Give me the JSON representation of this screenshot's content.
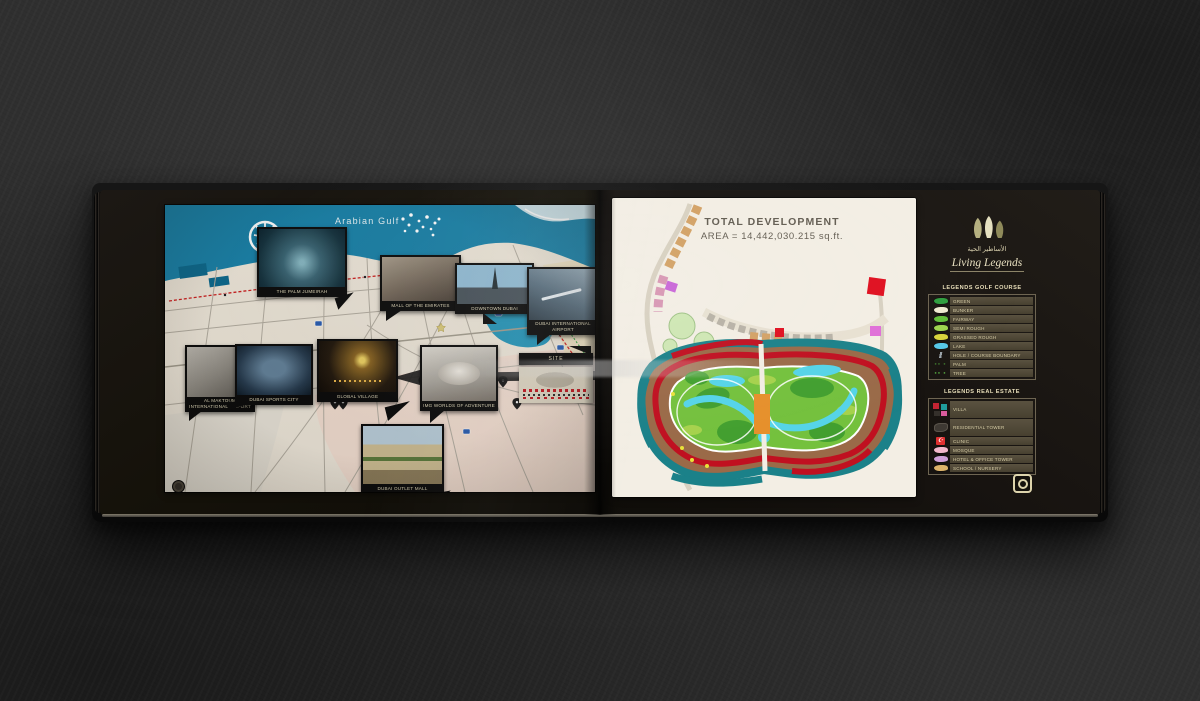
{
  "left_page": {
    "map": {
      "sea_label": "Arabian Gulf",
      "area_label": "Business Bay",
      "callouts": {
        "palm": "THE PALM JUMEIRAH",
        "mall": "MALL OF THE EMIRATES",
        "downtown": "DOWNTOWN DUBAI",
        "dxb": "DUBAI INTERNATIONAL AIRPORT",
        "maktoum": "AL MAKTOUM INTERNATIONAL AIRPORT",
        "sports_city": "DUBAI SPORTS CITY",
        "global_village": "GLOBAL VILLAGE",
        "img_worlds": "IMG WORLDS OF ADVENTURE",
        "outlet_mall": "DUBAI OUTLET MALL",
        "site": "SITE"
      }
    }
  },
  "right_page": {
    "title_line1": "TOTAL DEVELOPMENT",
    "title_line2": "AREA = 14,442,030.215 sq.ft.",
    "brand": {
      "arabic": "الأساطير الحية",
      "name": "Living Legends"
    },
    "golf_legend": {
      "heading": "LEGENDS GOLF COURSE",
      "items": [
        {
          "label": "GREEN",
          "icon": "swatch",
          "color": "#2f9e3f"
        },
        {
          "label": "BUNKER",
          "icon": "swatch",
          "color": "#f0ead2"
        },
        {
          "label": "FAIRWAY",
          "icon": "swatch",
          "color": "#63bf3a"
        },
        {
          "label": "SEMI ROUGH",
          "icon": "swatch",
          "color": "#9ed44e"
        },
        {
          "label": "GRASSED ROUGH",
          "icon": "swatch",
          "color": "#d8d43c"
        },
        {
          "label": "LAKE",
          "icon": "swatch",
          "color": "#56c8e8"
        },
        {
          "label": "HOLE / COURSE BOUNDARY",
          "icon": "line",
          "color": "#9ba4aa"
        },
        {
          "label": "PALM",
          "icon": "dots",
          "color": "#3a6b2a"
        },
        {
          "label": "TREE",
          "icon": "dots",
          "color": "#4e9a3c"
        }
      ]
    },
    "estate_legend": {
      "heading": "LEGENDS REAL ESTATE",
      "items": [
        {
          "label": "VILLA",
          "icon": "villa",
          "color": "#c32433",
          "tall": true
        },
        {
          "label": "RESIDENTIAL TOWER",
          "icon": "tower",
          "color": "#3e3933",
          "tall": true
        },
        {
          "label": "CLINIC",
          "icon": "crescent",
          "color": "#e03030"
        },
        {
          "label": "MOSQUE",
          "icon": "swatch",
          "color": "#f2b8cc"
        },
        {
          "label": "HOTEL & OFFICE TOWER",
          "icon": "swatch",
          "color": "#cfa0d8"
        },
        {
          "label": "SCHOOL / NURSERY",
          "icon": "swatch",
          "color": "#dcb36a"
        }
      ]
    }
  },
  "colors": {
    "sea": "#1a81a8",
    "land": "#ece5d8",
    "metro_line": "#cc2222",
    "plan_red": "#cf1722",
    "plan_teal": "#1b8189",
    "plan_brown": "#9a6a48",
    "golf_green": "#74c13d",
    "water_cyan": "#55d4e8",
    "accent_cream": "#e6debf"
  }
}
